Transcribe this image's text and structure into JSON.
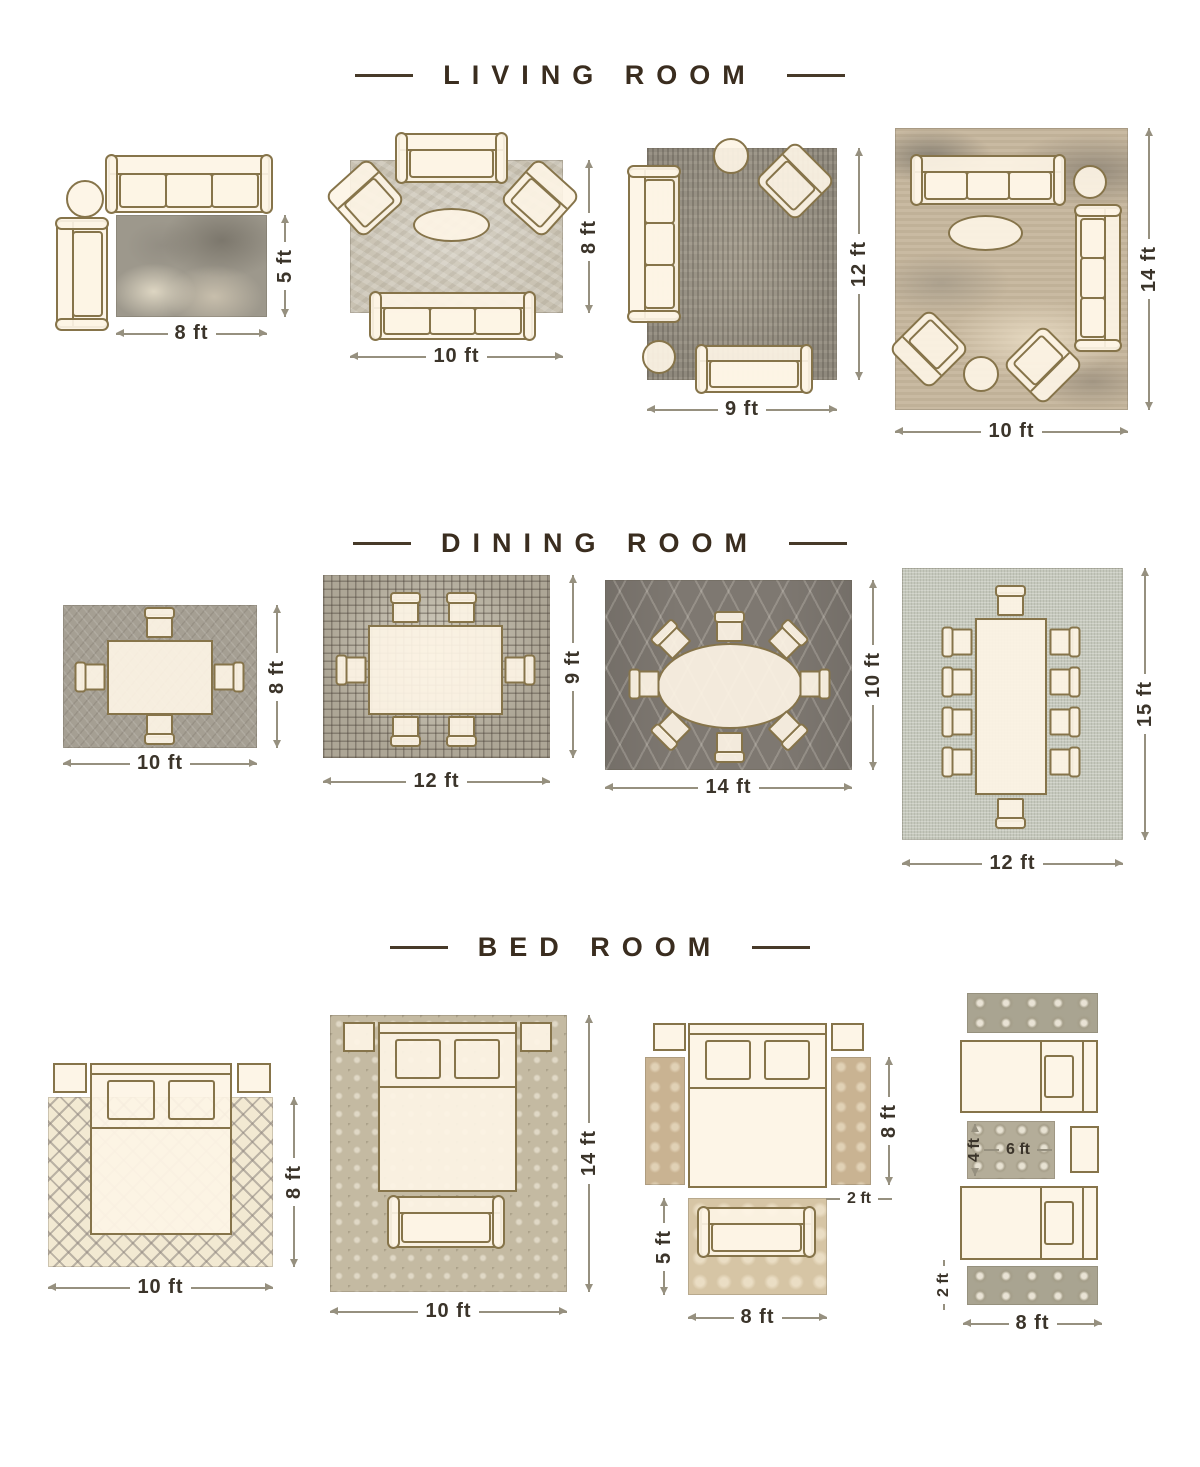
{
  "page_title": "Rug size guide by room",
  "colors": {
    "title_text": "#3a2d1f",
    "dimension_text": "#3b342a",
    "dimension_line": "#96907f",
    "furniture_outline": "#86744a",
    "furniture_fill": "#fdf4e5"
  },
  "sections": [
    {
      "title": "LIVING ROOM",
      "layouts": [
        {
          "width_label": "8 ft",
          "height_label": "5 ft"
        },
        {
          "width_label": "10 ft",
          "height_label": "8 ft"
        },
        {
          "width_label": "9 ft",
          "height_label": "12 ft"
        },
        {
          "width_label": "10 ft",
          "height_label": "14 ft"
        }
      ]
    },
    {
      "title": "DINING ROOM",
      "layouts": [
        {
          "width_label": "10 ft",
          "height_label": "8 ft"
        },
        {
          "width_label": "12 ft",
          "height_label": "9 ft"
        },
        {
          "width_label": "14 ft",
          "height_label": "10 ft"
        },
        {
          "width_label": "12 ft",
          "height_label": "15 ft"
        }
      ]
    },
    {
      "title": "BED ROOM",
      "layouts": [
        {
          "width_label": "10 ft",
          "height_label": "8 ft"
        },
        {
          "width_label": "10 ft",
          "height_label": "14 ft"
        },
        {
          "runner_length_label": "8 ft",
          "runner_width_label": "2 ft",
          "foot_rug_width_label": "8 ft",
          "foot_rug_height_label": "5 ft"
        },
        {
          "mid_rug_width_label": "6 ft",
          "mid_rug_height_label": "4 ft",
          "runner_height_label": "2 ft",
          "bottom_width_label": "8 ft"
        }
      ]
    }
  ]
}
